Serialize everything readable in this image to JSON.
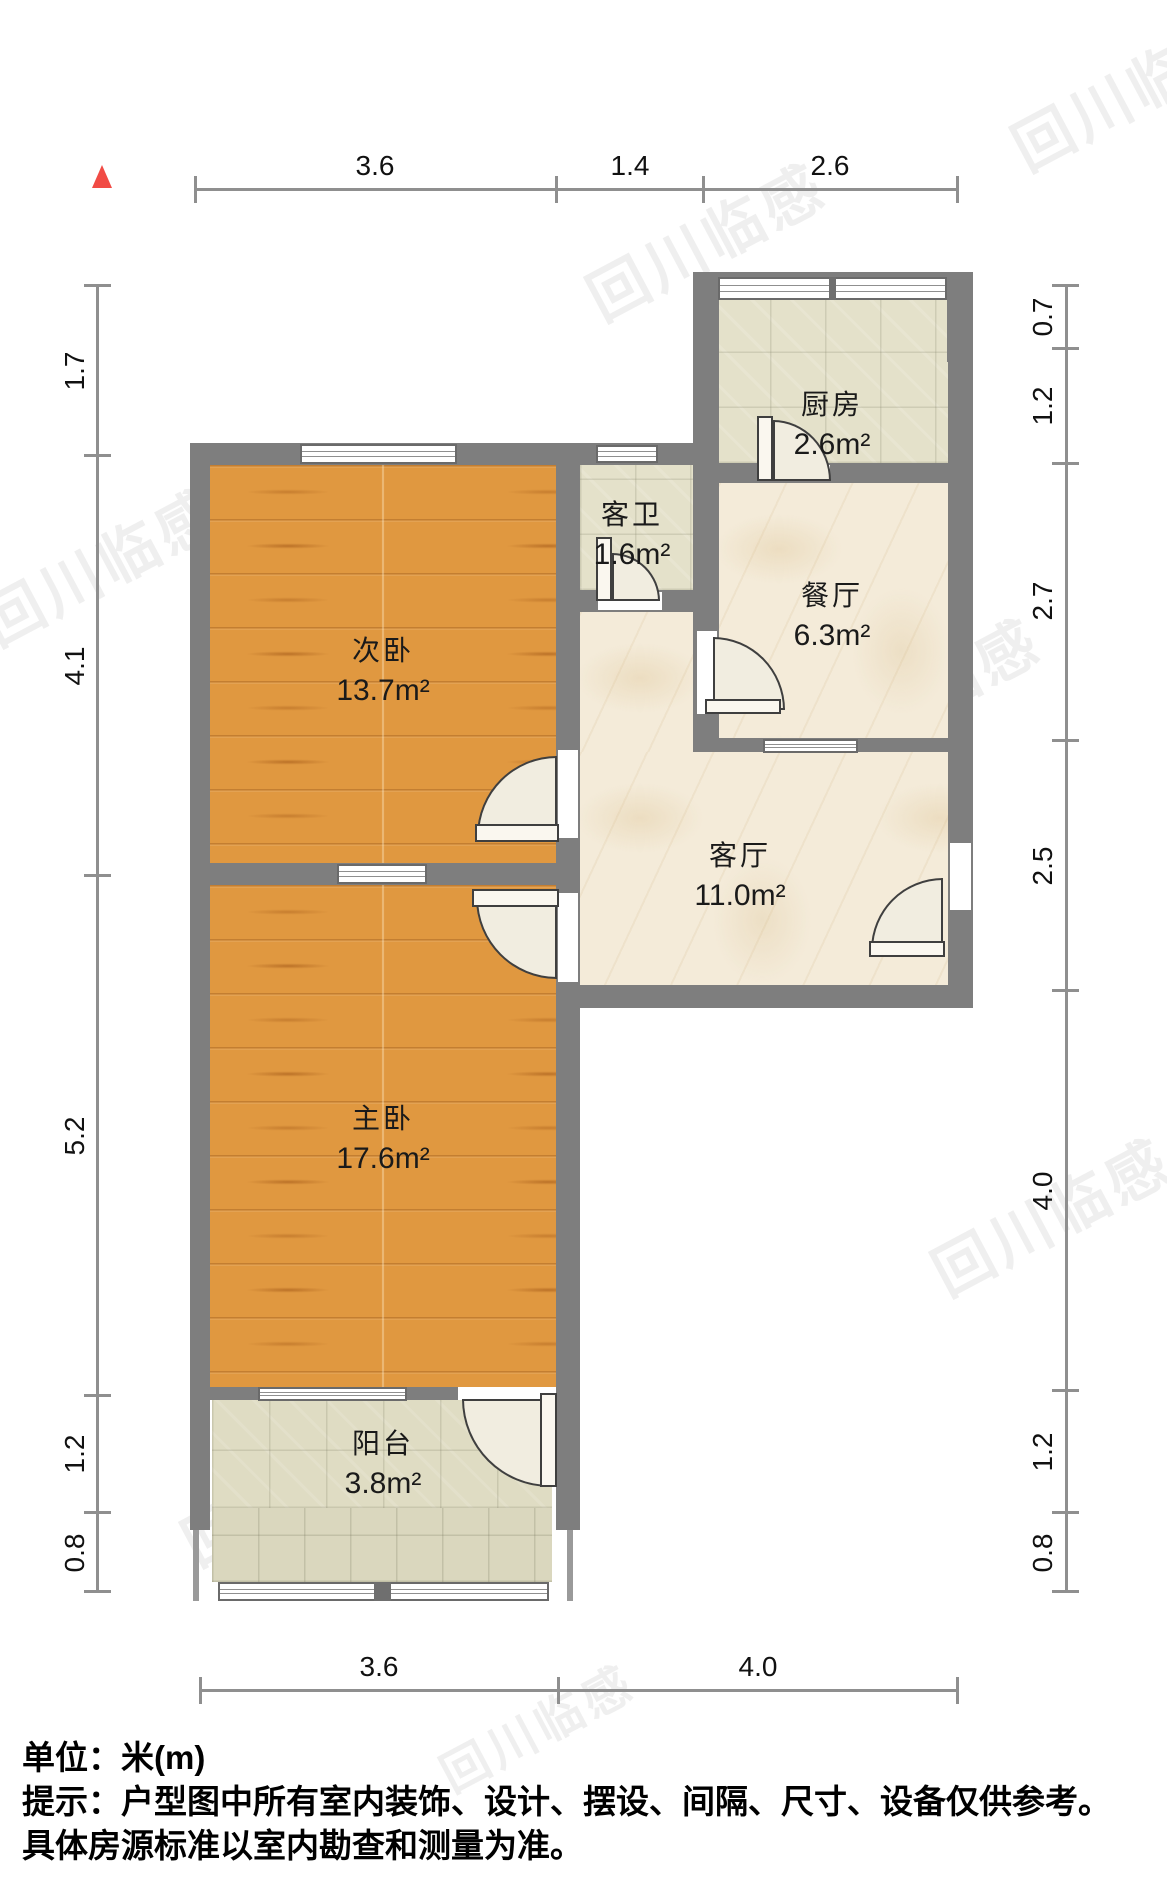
{
  "rooms": [
    {
      "name": "厨房",
      "area": "2.6m²"
    },
    {
      "name": "客卫",
      "area": "1.6m²"
    },
    {
      "name": "餐厅",
      "area": "6.3m²"
    },
    {
      "name": "次卧",
      "area": "13.7m²"
    },
    {
      "name": "客厅",
      "area": "11.0m²"
    },
    {
      "name": "主卧",
      "area": "17.6m²"
    },
    {
      "name": "阳台",
      "area": "3.8m²"
    }
  ],
  "dims": {
    "top": [
      "3.6",
      "1.4",
      "2.6"
    ],
    "bottom": [
      "3.6",
      "4.0"
    ],
    "left": [
      "1.7",
      "4.1",
      "5.2",
      "1.2",
      "0.8"
    ],
    "right": [
      "0.7",
      "1.2",
      "2.7",
      "2.5",
      "4.0",
      "1.2",
      "0.8"
    ]
  },
  "footer": {
    "unit_line": "单位：米(m)",
    "tip_line1": "提示：户型图中所有室内装饰、设计、摆设、间隔、尺寸、设备仅供参考。",
    "tip_line2": "具体房源标准以室内勘查和测量为准。"
  },
  "watermark": {
    "text": "回川临感"
  },
  "colors": {
    "wall": "#7E7E7E",
    "wood_floor": "#E09840",
    "marble_floor": "#F4EBD9",
    "tile_floor": "#E4E1CA",
    "north_arrow": "#F14B45",
    "dim_text": "#111111"
  }
}
